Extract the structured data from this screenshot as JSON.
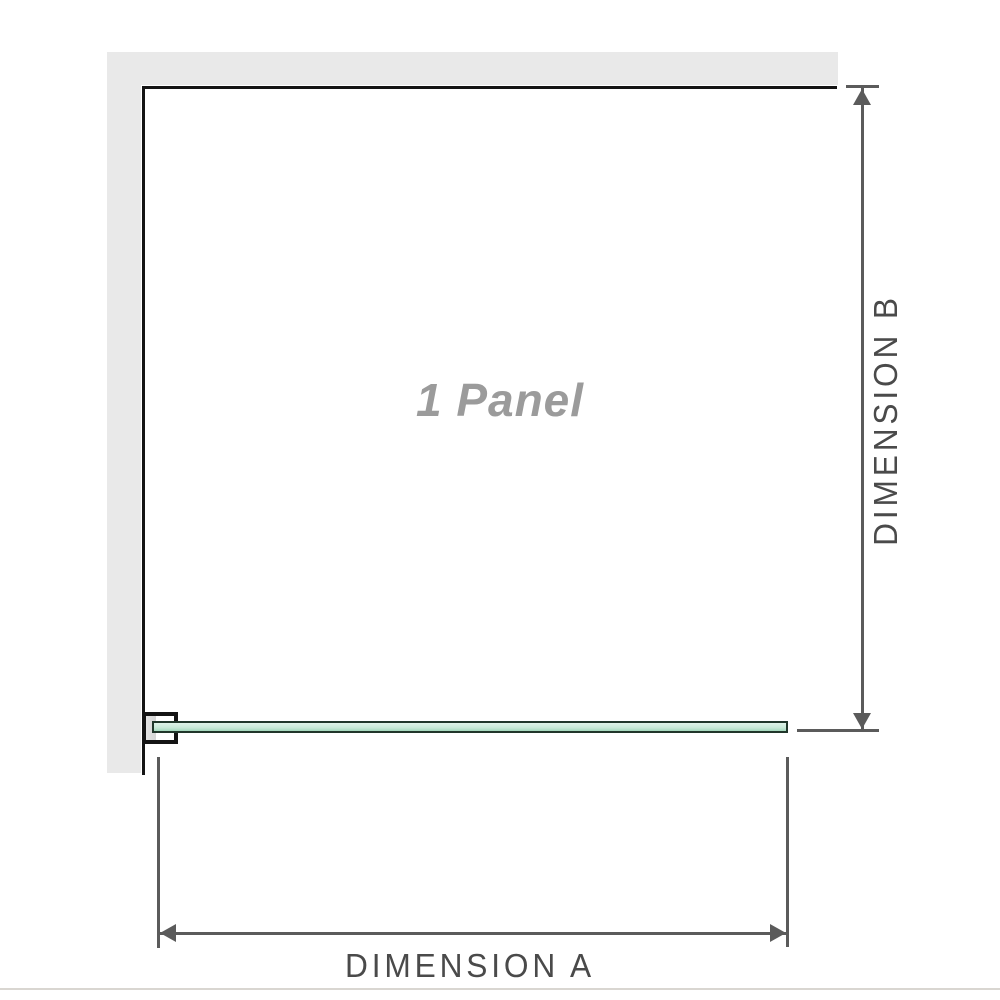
{
  "diagram": {
    "panel_label": "1 Panel",
    "dimension_a_label": "DIMENSION A",
    "dimension_b_label": "DIMENSION B"
  },
  "colors": {
    "wall_fill": "#e9e9e9",
    "outline": "#141414",
    "dimension_line": "#5b5b5b",
    "dimension_text": "#4a4a4a",
    "panel_text": "#9b9b9b",
    "glass_border": "#20362a",
    "glass_top": "#def2e8",
    "glass_bottom": "#a3d8bc",
    "bracket_fill": "#d5d5d5",
    "footer_line": "#d9d6d1"
  }
}
